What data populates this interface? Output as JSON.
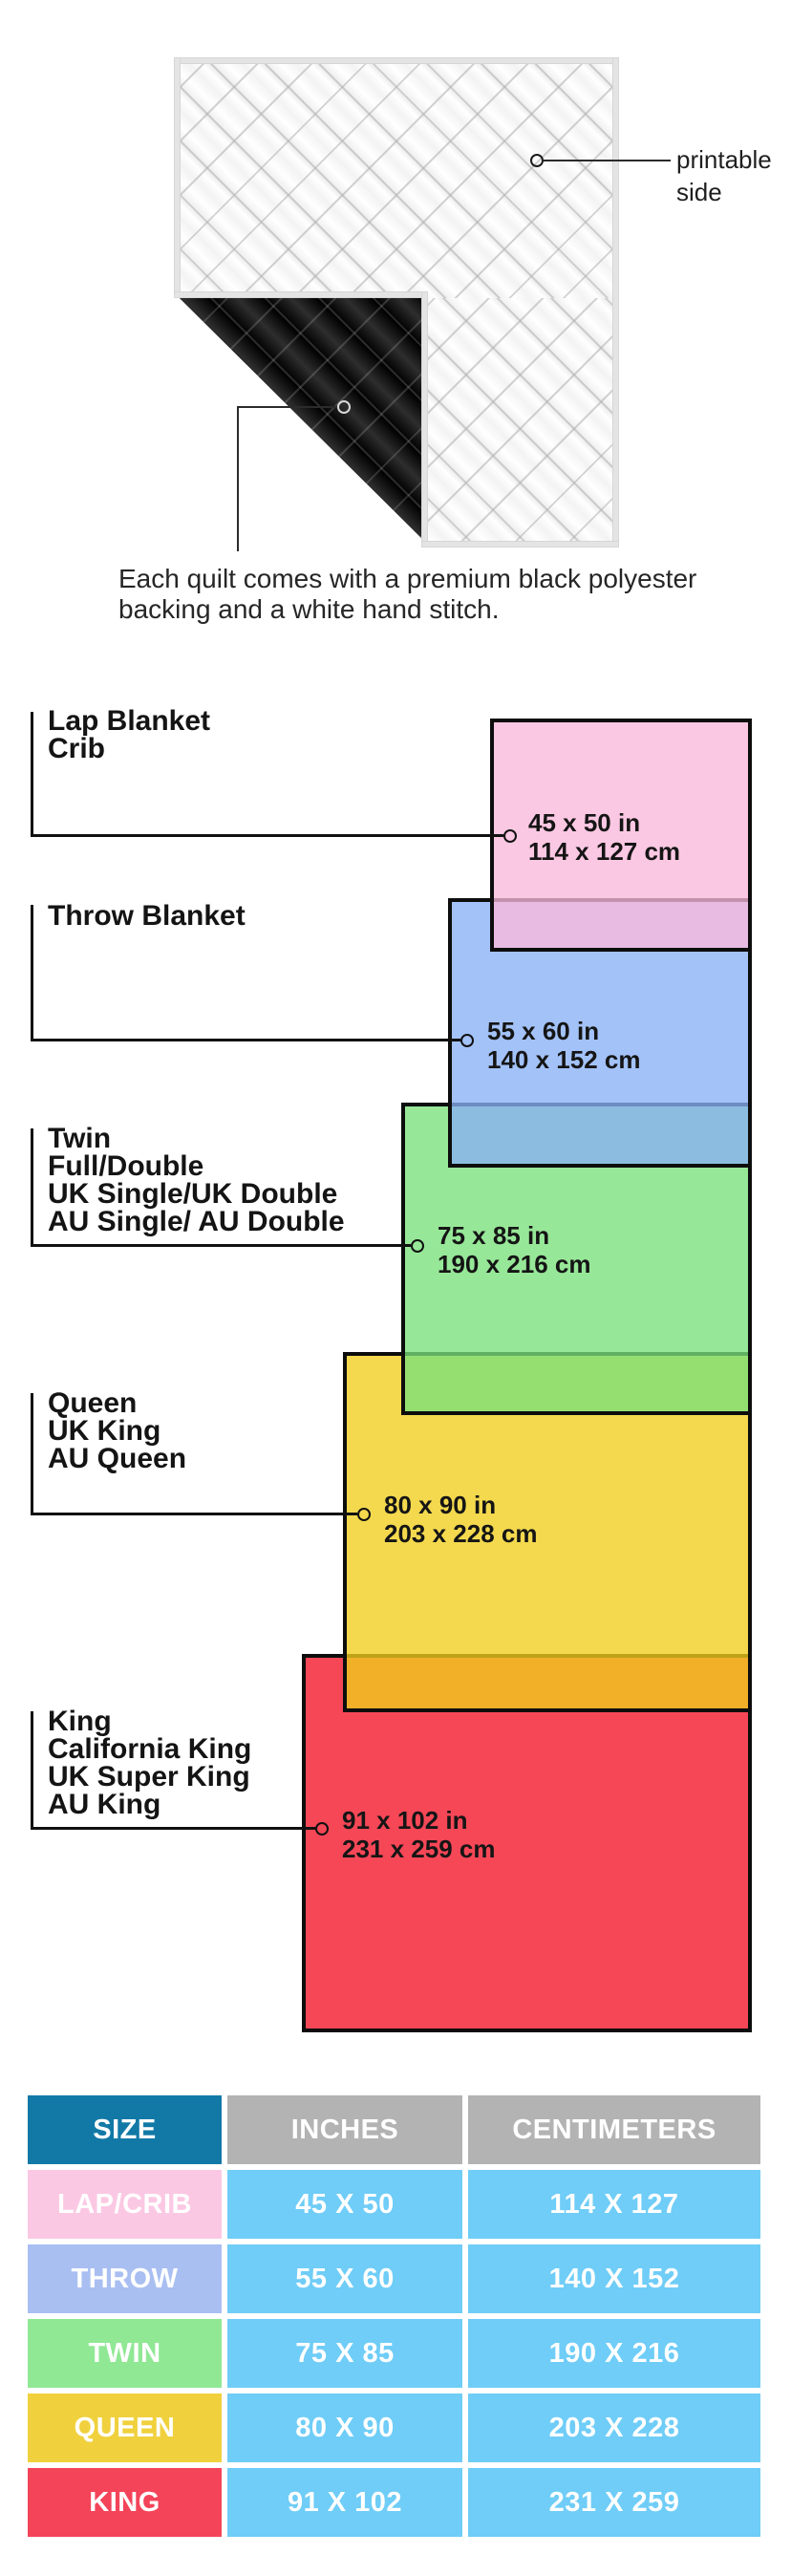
{
  "quilt": {
    "printable_label": "printable side",
    "caption": "Each quilt comes with a premium black polyester backing and a white hand stitch.",
    "front_color": "#ffffff",
    "backing_color": "#161616"
  },
  "diagram": {
    "sizes": [
      {
        "id": "lap-crib",
        "label_lines": [
          "Lap Blanket",
          "Crib"
        ],
        "inches": "45 x 50 in",
        "cm": "114 x 127 cm",
        "color": "#fbc8e3"
      },
      {
        "id": "throw",
        "label_lines": [
          "Throw Blanket"
        ],
        "inches": "55 x 60 in",
        "cm": "140 x 152 cm",
        "color": "#a3c2f8"
      },
      {
        "id": "twin",
        "label_lines": [
          "Twin",
          "Full/Double",
          "UK Single/UK Double",
          "AU Single/ AU Double"
        ],
        "inches": "75 x 85 in",
        "cm": "190 x 216 cm",
        "color": "#97e798"
      },
      {
        "id": "queen",
        "label_lines": [
          "Queen",
          "UK King",
          "AU Queen"
        ],
        "inches": "80 x 90 in",
        "cm": "203 x 228 cm",
        "color": "#f4d94e"
      },
      {
        "id": "king",
        "label_lines": [
          "King",
          "California King",
          "UK Super King",
          "AU King"
        ],
        "inches": "91 x 102 in",
        "cm": "231 x 259 cm",
        "color": "#f6475a"
      }
    ],
    "overlap_colors": {
      "pink_over_blue": "#e0b4e0",
      "blue_over_green": "#8cbde1",
      "green_over_yellow": "#95de71",
      "yellow_over_red": "#f2b029"
    },
    "border_color": "#0d0d0d"
  },
  "table": {
    "headers": [
      "SIZE",
      "INCHES",
      "CENTIMETERS"
    ],
    "rows": [
      {
        "size": "LAP/CRIB",
        "inches": "45 X 50",
        "cm": "114 X 127",
        "color": "#fbc8e3"
      },
      {
        "size": "THROW",
        "inches": "55 X 60",
        "cm": "140 X 152",
        "color": "#a9bff2"
      },
      {
        "size": "TWIN",
        "inches": "75 X 85",
        "cm": "190 X 216",
        "color": "#90e895"
      },
      {
        "size": "QUEEN",
        "inches": "80 X 90",
        "cm": "203 X 228",
        "color": "#f0d13d"
      },
      {
        "size": "KING",
        "inches": "91 X 102",
        "cm": "231 X 259",
        "color": "#f4445a"
      }
    ],
    "header_size_color": "#1279a7",
    "header_gray_color": "#b3b3b3",
    "data_cell_color": "#6fcdf7"
  }
}
